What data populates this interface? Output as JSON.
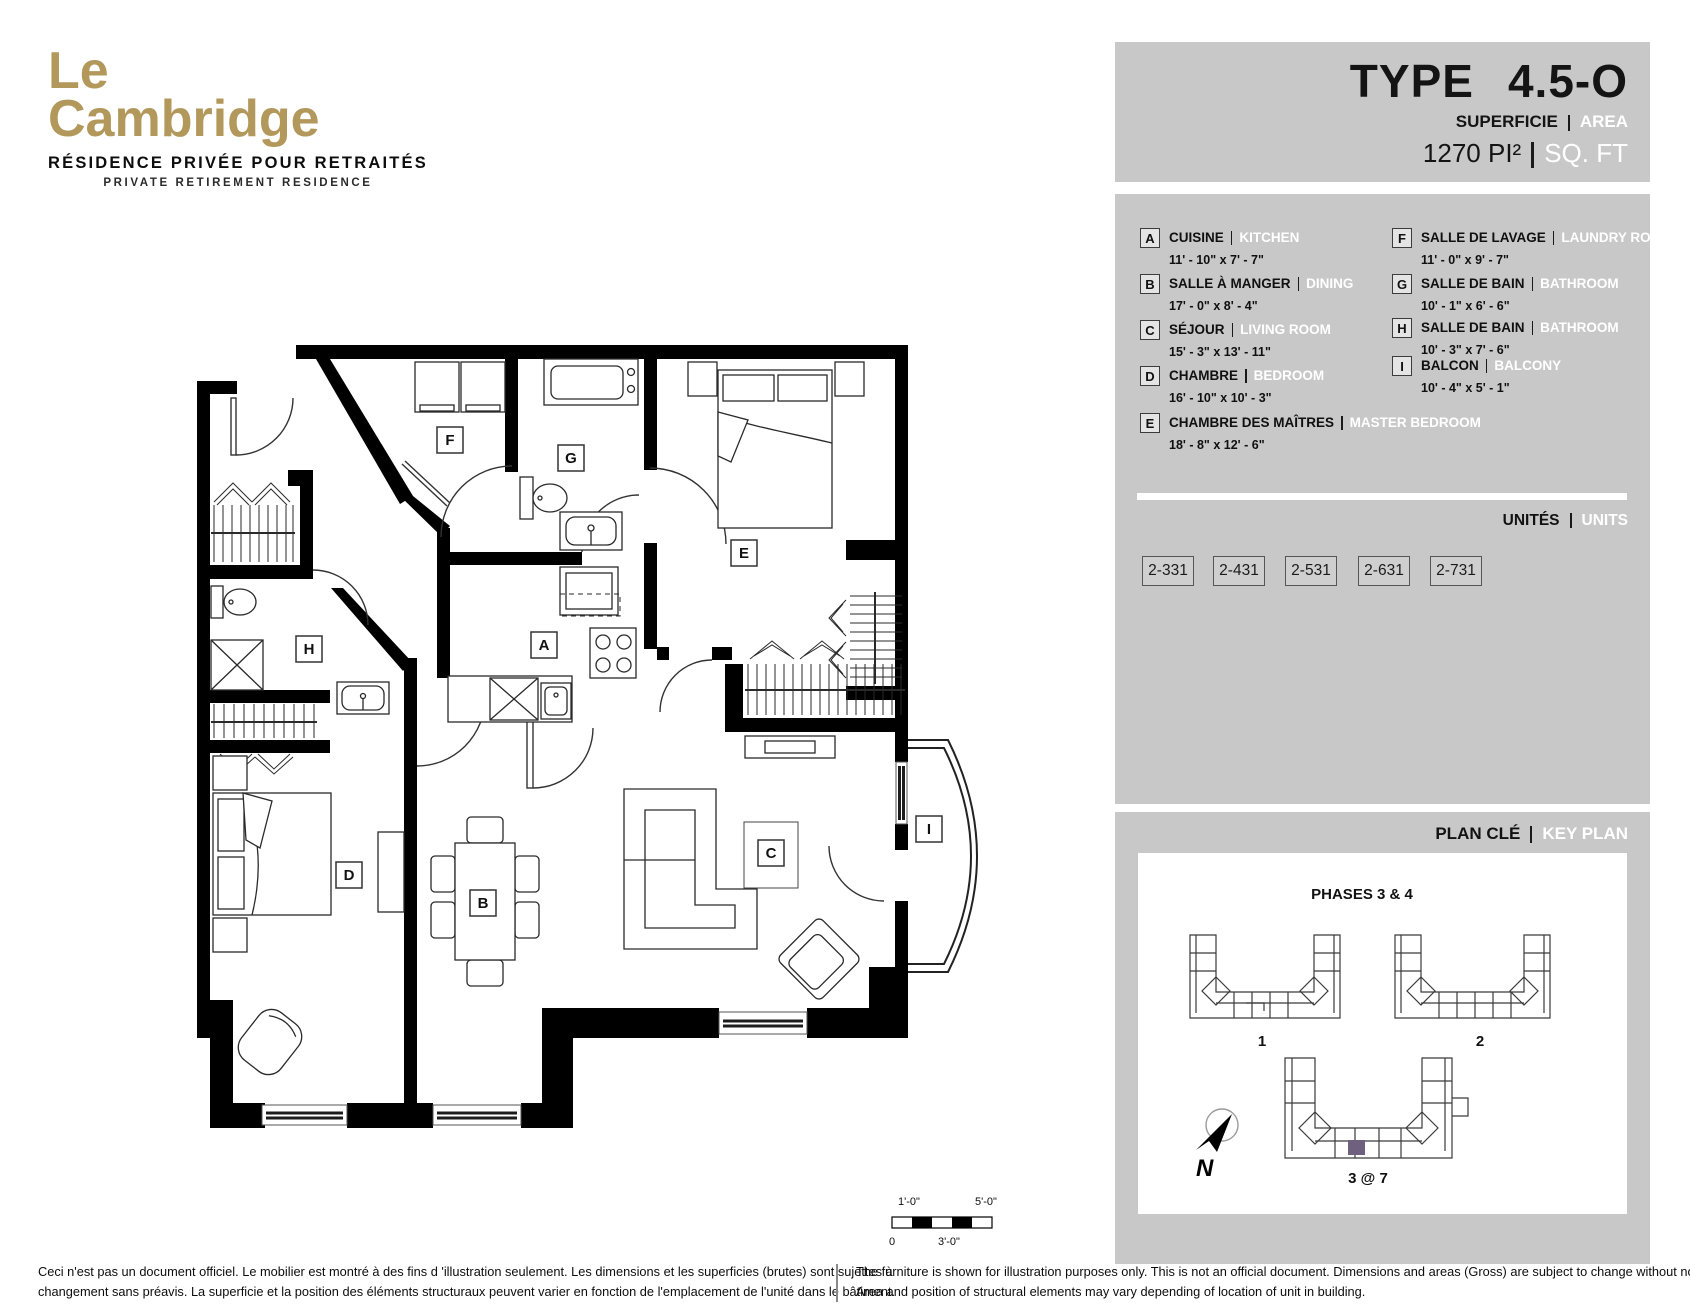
{
  "logo": {
    "line1": "Le",
    "line2": "Cambridge",
    "subtitle_fr": "RÉSIDENCE PRIVÉE POUR RETRAITÉS",
    "subtitle_en": "PRIVATE RETIREMENT RESIDENCE"
  },
  "header": {
    "type_label": "TYPE",
    "type_value": "4.5-O",
    "area_fr": "SUPERFICIE",
    "area_en": "AREA",
    "size_fr": "1270 PI²",
    "size_en": "SQ. FT"
  },
  "legend": {
    "rooms": [
      {
        "letter": "A",
        "name_fr": "CUISINE",
        "name_en": "KITCHEN",
        "dims": "11' - 10\" x 7' - 7\""
      },
      {
        "letter": "B",
        "name_fr": "SALLE À MANGER",
        "name_en": "DINING",
        "dims": "17' - 0\" x 8' - 4\""
      },
      {
        "letter": "C",
        "name_fr": "SÉJOUR",
        "name_en": "LIVING ROOM",
        "dims": "15' - 3\" x 13' - 11\""
      },
      {
        "letter": "D",
        "name_fr": "CHAMBRE",
        "name_en": "BEDROOM",
        "dims": "16' - 10\" x 10' - 3\""
      },
      {
        "letter": "E",
        "name_fr": "CHAMBRE DES MAÎTRES",
        "name_en": "MASTER BEDROOM",
        "dims": "18' - 8\" x 12' - 6\""
      },
      {
        "letter": "F",
        "name_fr": "SALLE DE LAVAGE",
        "name_en": "LAUNDRY ROOM",
        "dims": "11' - 0\" x 9' - 7\""
      },
      {
        "letter": "G",
        "name_fr": "SALLE DE BAIN",
        "name_en": "BATHROOM",
        "dims": "10' - 1\" x 6' - 6\""
      },
      {
        "letter": "H",
        "name_fr": "SALLE DE BAIN",
        "name_en": "BATHROOM",
        "dims": "10' - 3\" x 7' - 6\""
      },
      {
        "letter": "I",
        "name_fr": "BALCON",
        "name_en": "BALCONY",
        "dims": "10' - 4\" x 5' - 1\""
      }
    ]
  },
  "units": {
    "title_fr": "UNITÉS",
    "title_en": "UNITS",
    "list": [
      "2-331",
      "2-431",
      "2-531",
      "2-631",
      "2-731"
    ]
  },
  "keyplan": {
    "title_fr": "PLAN CLÉ",
    "title_en": "KEY PLAN",
    "phases": "PHASES 3 & 4",
    "buildings": [
      "1",
      "2",
      "3 @ 7"
    ],
    "north": "N",
    "highlight_color": "#6f6080"
  },
  "floorplan": {
    "labels": [
      "F",
      "G",
      "E",
      "H",
      "A",
      "D",
      "B",
      "C",
      "I"
    ]
  },
  "scalebar": {
    "top_left": "1'-0\"",
    "top_right": "5'-0\"",
    "bottom_left": "0",
    "bottom_mid": "3'-0\""
  },
  "footer": {
    "fr_line1": "Ceci n'est pas un document officiel.  Le mobilier est montré à des fins d 'illustration seulement.  Les dimensions et les superficies (brutes) sont sujettes à",
    "fr_line2": "changement sans préavis. La superficie et la position des éléments structuraux peuvent varier en fonction de l'emplacement de l'unité dans le bâtiment.",
    "en_line1": "The furniture is shown for illustration purposes only.  This is not an official document.  Dimensions and areas (Gross) are subject to change without notice.",
    "en_line2": "Area and position of structural elements may vary depending of location of unit in building."
  },
  "colors": {
    "gold": "#b3985c",
    "panel_gray": "#c8c8c8"
  }
}
